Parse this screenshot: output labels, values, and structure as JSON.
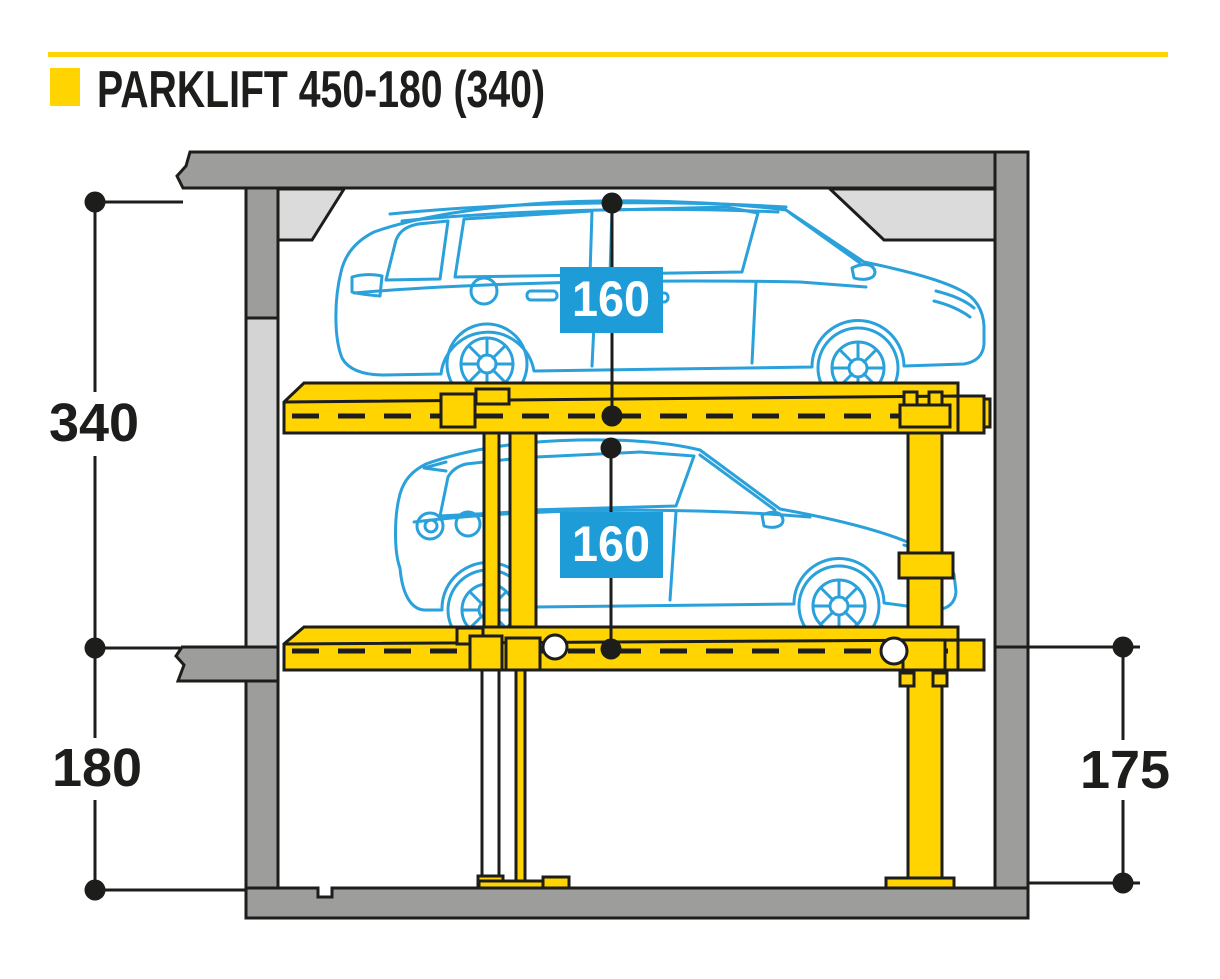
{
  "header": {
    "title": "PARKLIFT 450-180 (340)",
    "bullet_icon": "yellow-square-icon",
    "rule_color": "#FFD400"
  },
  "dimensions": {
    "overall_height": "340",
    "pit_depth_left": "180",
    "pit_depth_right": "175",
    "upper_car_clearance": "160",
    "lower_car_clearance": "160"
  },
  "colors": {
    "accent_yellow": "#FFD400",
    "outline_black": "#1D1D1B",
    "car_blue": "#2AA1DA",
    "badge_blue": "#1E9CD8",
    "wall_gray": "#9D9D9C",
    "wall_light_gray": "#D4D4D4",
    "haunch_gray": "#DBDBDB"
  }
}
